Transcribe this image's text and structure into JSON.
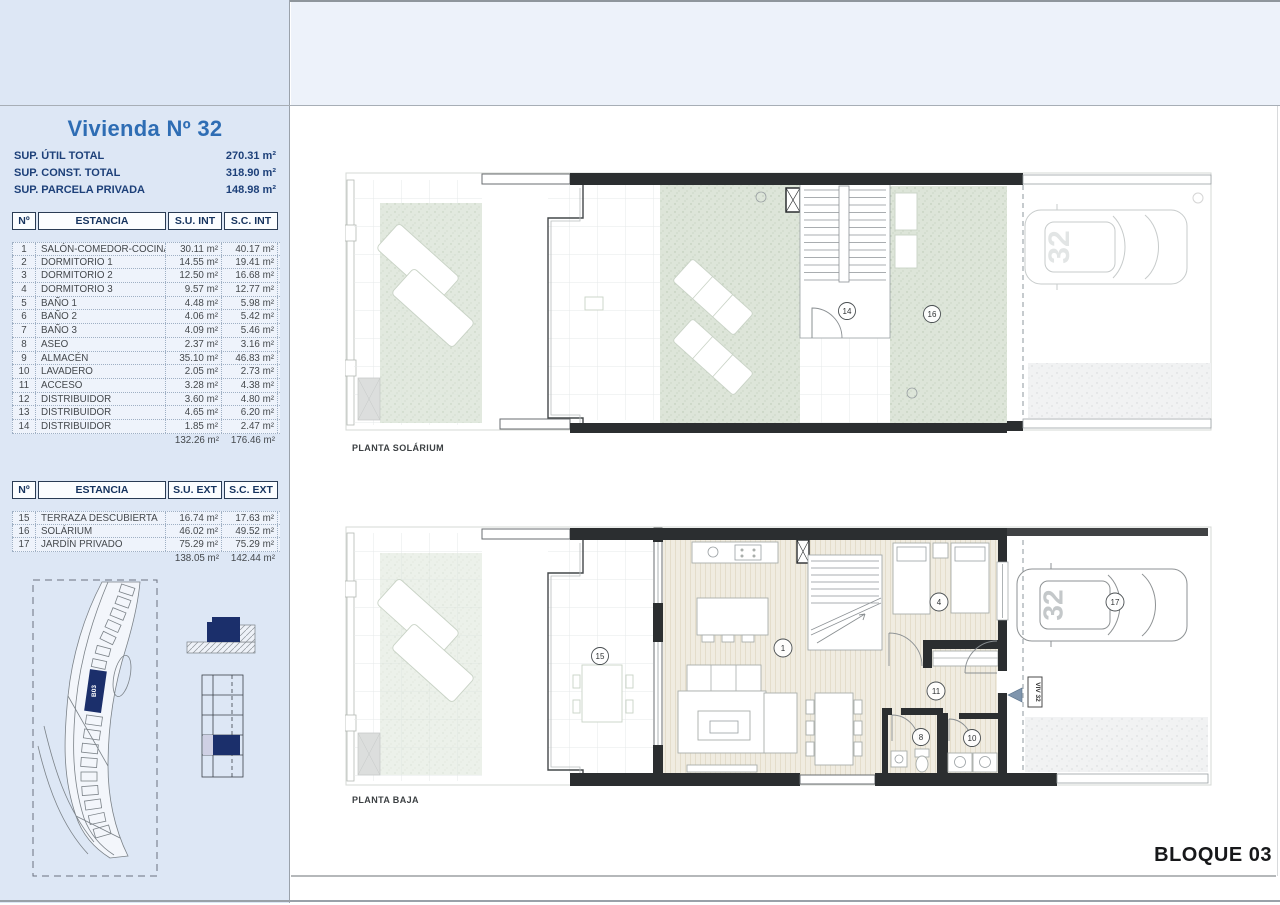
{
  "panel": {
    "title": "Vivienda Nº 32",
    "summary": [
      {
        "label": "SUP. ÚTIL TOTAL",
        "value": "270.31 m²"
      },
      {
        "label": "SUP. CONST. TOTAL",
        "value": "318.90 m²"
      },
      {
        "label": "SUP. PARCELA PRIVADA",
        "value": "148.98 m²"
      }
    ],
    "interior_table": {
      "headers": [
        "Nº",
        "ESTANCIA",
        "S.U. INT",
        "S.C. INT"
      ],
      "rows": [
        {
          "num": "1",
          "name": "SALÓN-COMEDOR-COCINA",
          "su": "30.11 m²",
          "sc": "40.17 m²"
        },
        {
          "num": "2",
          "name": "DORMITORIO 1",
          "su": "14.55 m²",
          "sc": "19.41 m²"
        },
        {
          "num": "3",
          "name": "DORMITORIO 2",
          "su": "12.50 m²",
          "sc": "16.68 m²"
        },
        {
          "num": "4",
          "name": "DORMITORIO 3",
          "su": "9.57 m²",
          "sc": "12.77 m²"
        },
        {
          "num": "5",
          "name": "BAÑO 1",
          "su": "4.48 m²",
          "sc": "5.98 m²"
        },
        {
          "num": "6",
          "name": "BAÑO 2",
          "su": "4.06 m²",
          "sc": "5.42 m²"
        },
        {
          "num": "7",
          "name": "BAÑO 3",
          "su": "4.09 m²",
          "sc": "5.46 m²"
        },
        {
          "num": "8",
          "name": "ASEO",
          "su": "2.37 m²",
          "sc": "3.16 m²"
        },
        {
          "num": "9",
          "name": "ALMACÉN",
          "su": "35.10 m²",
          "sc": "46.83 m²"
        },
        {
          "num": "10",
          "name": "LAVADERO",
          "su": "2.05 m²",
          "sc": "2.73 m²"
        },
        {
          "num": "11",
          "name": "ACCESO",
          "su": "3.28 m²",
          "sc": "4.38 m²"
        },
        {
          "num": "12",
          "name": "DISTRIBUIDOR",
          "su": "3.60 m²",
          "sc": "4.80 m²"
        },
        {
          "num": "13",
          "name": "DISTRIBUIDOR",
          "su": "4.65 m²",
          "sc": "6.20 m²"
        },
        {
          "num": "14",
          "name": "DISTRIBUIDOR",
          "su": "1.85 m²",
          "sc": "2.47 m²"
        }
      ],
      "total_su": "132.26 m²",
      "total_sc": "176.46 m²"
    },
    "exterior_table": {
      "headers": [
        "Nº",
        "ESTANCIA",
        "S.U. EXT",
        "S.C. EXT"
      ],
      "rows": [
        {
          "num": "15",
          "name": "TERRAZA DESCUBIERTA",
          "su": "16.74 m²",
          "sc": "17.63 m²"
        },
        {
          "num": "16",
          "name": "SOLÁRIUM",
          "su": "46.02 m²",
          "sc": "49.52 m²"
        },
        {
          "num": "17",
          "name": "JARDÍN PRIVADO",
          "su": "75.29 m²",
          "sc": "75.29 m²"
        }
      ],
      "total_su": "138.05 m²",
      "total_sc": "142.44 m²"
    },
    "site_block_label": "B03"
  },
  "plans": {
    "solarium": {
      "caption": "PLANTA SOLÁRIUM",
      "car_number": "32",
      "labels": {
        "stair": "14",
        "solarium": "16"
      }
    },
    "baja": {
      "caption": "PLANTA BAJA",
      "car_number": "32",
      "viv_sign": "VIV 32",
      "labels": {
        "living": "1",
        "bedroom": "4",
        "bath": "8",
        "laundry": "10",
        "hall": "11",
        "terrace": "15",
        "garden": "17"
      }
    }
  },
  "footer": {
    "block_label": "BLOQUE 03"
  },
  "colors": {
    "accent_navy": "#1b2f6b",
    "panel_blue": "#dde7f5",
    "plan_green": "#dde5d9"
  }
}
